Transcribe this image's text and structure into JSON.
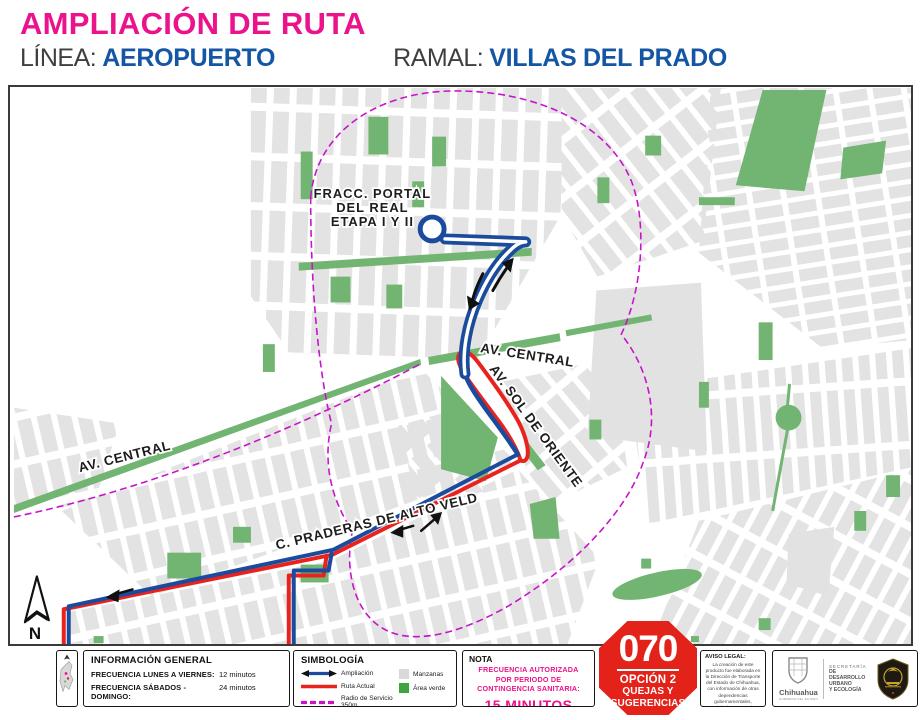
{
  "header": {
    "title": "AMPLIACIÓN DE RUTA",
    "linea_label": "LÍNEA:",
    "linea_value": "AEROPUERTO",
    "ramal_label": "RAMAL:",
    "ramal_value": "VILLAS DEL PRADO"
  },
  "map": {
    "labels": {
      "fracc_1": "FRACC. PORTAL",
      "fracc_2": "DEL REAL",
      "fracc_3": "ETAPA I Y II",
      "av_central_right": "AV. CENTRAL",
      "av_sol_oriente": "AV. SOL DE ORIENTE",
      "av_central_left": "AV. CENTRAL",
      "praderas": "C. PRADERAS DE ALTO VELD",
      "north": "N"
    },
    "colors": {
      "ampliacion": "#1a4b9d",
      "ruta_actual": "#e8231e",
      "radio_servicio": "#c913cb",
      "manzanas": "#e2e2e2",
      "area_verde": "#72b572"
    }
  },
  "info_general": {
    "title": "INFORMACIÓN GENERAL",
    "rows": [
      {
        "label": "FRECUENCIA LUNES A VIERNES:",
        "value": "12 minutos"
      },
      {
        "label": "FRECUENCIA SÁBADOS - DOMINGO:",
        "value": "24 minutos"
      }
    ]
  },
  "simbologia": {
    "title": "SIMBOLOGÍA",
    "items_left": [
      {
        "label": "Ampliación"
      },
      {
        "label": "Ruta Actual"
      },
      {
        "label": "Radio de Servicio 350m"
      }
    ],
    "items_right": [
      {
        "label": "Manzanas"
      },
      {
        "label": "Área verde"
      }
    ]
  },
  "nota": {
    "title": "NOTA",
    "lines": [
      "FRECUENCIA AUTORIZADA",
      "POR PERIODO DE",
      "CONTINGENCIA SANITARIA:"
    ],
    "value": "15 MINUTOS"
  },
  "quejas": {
    "number": "070",
    "option": "OPCIÓN 2",
    "line1": "QUEJAS Y",
    "line2": "SUGERENCIAS"
  },
  "aviso_legal": {
    "title": "AVISO LEGAL:",
    "body": "La creación de este producto fue elaborada en la Dirección de Transporte del Estado de Chihuahua, con información de otras dependencias gubernamentales, municipales y estatales."
  },
  "logos": {
    "state_name": "Chihuahua",
    "state_sub": "GOBIERNO DEL ESTADO",
    "secretaria_1": "SECRETARÍA",
    "secretaria_2": "DE DESARROLLO URBANO",
    "secretaria_3": "Y ECOLOGÍA"
  }
}
